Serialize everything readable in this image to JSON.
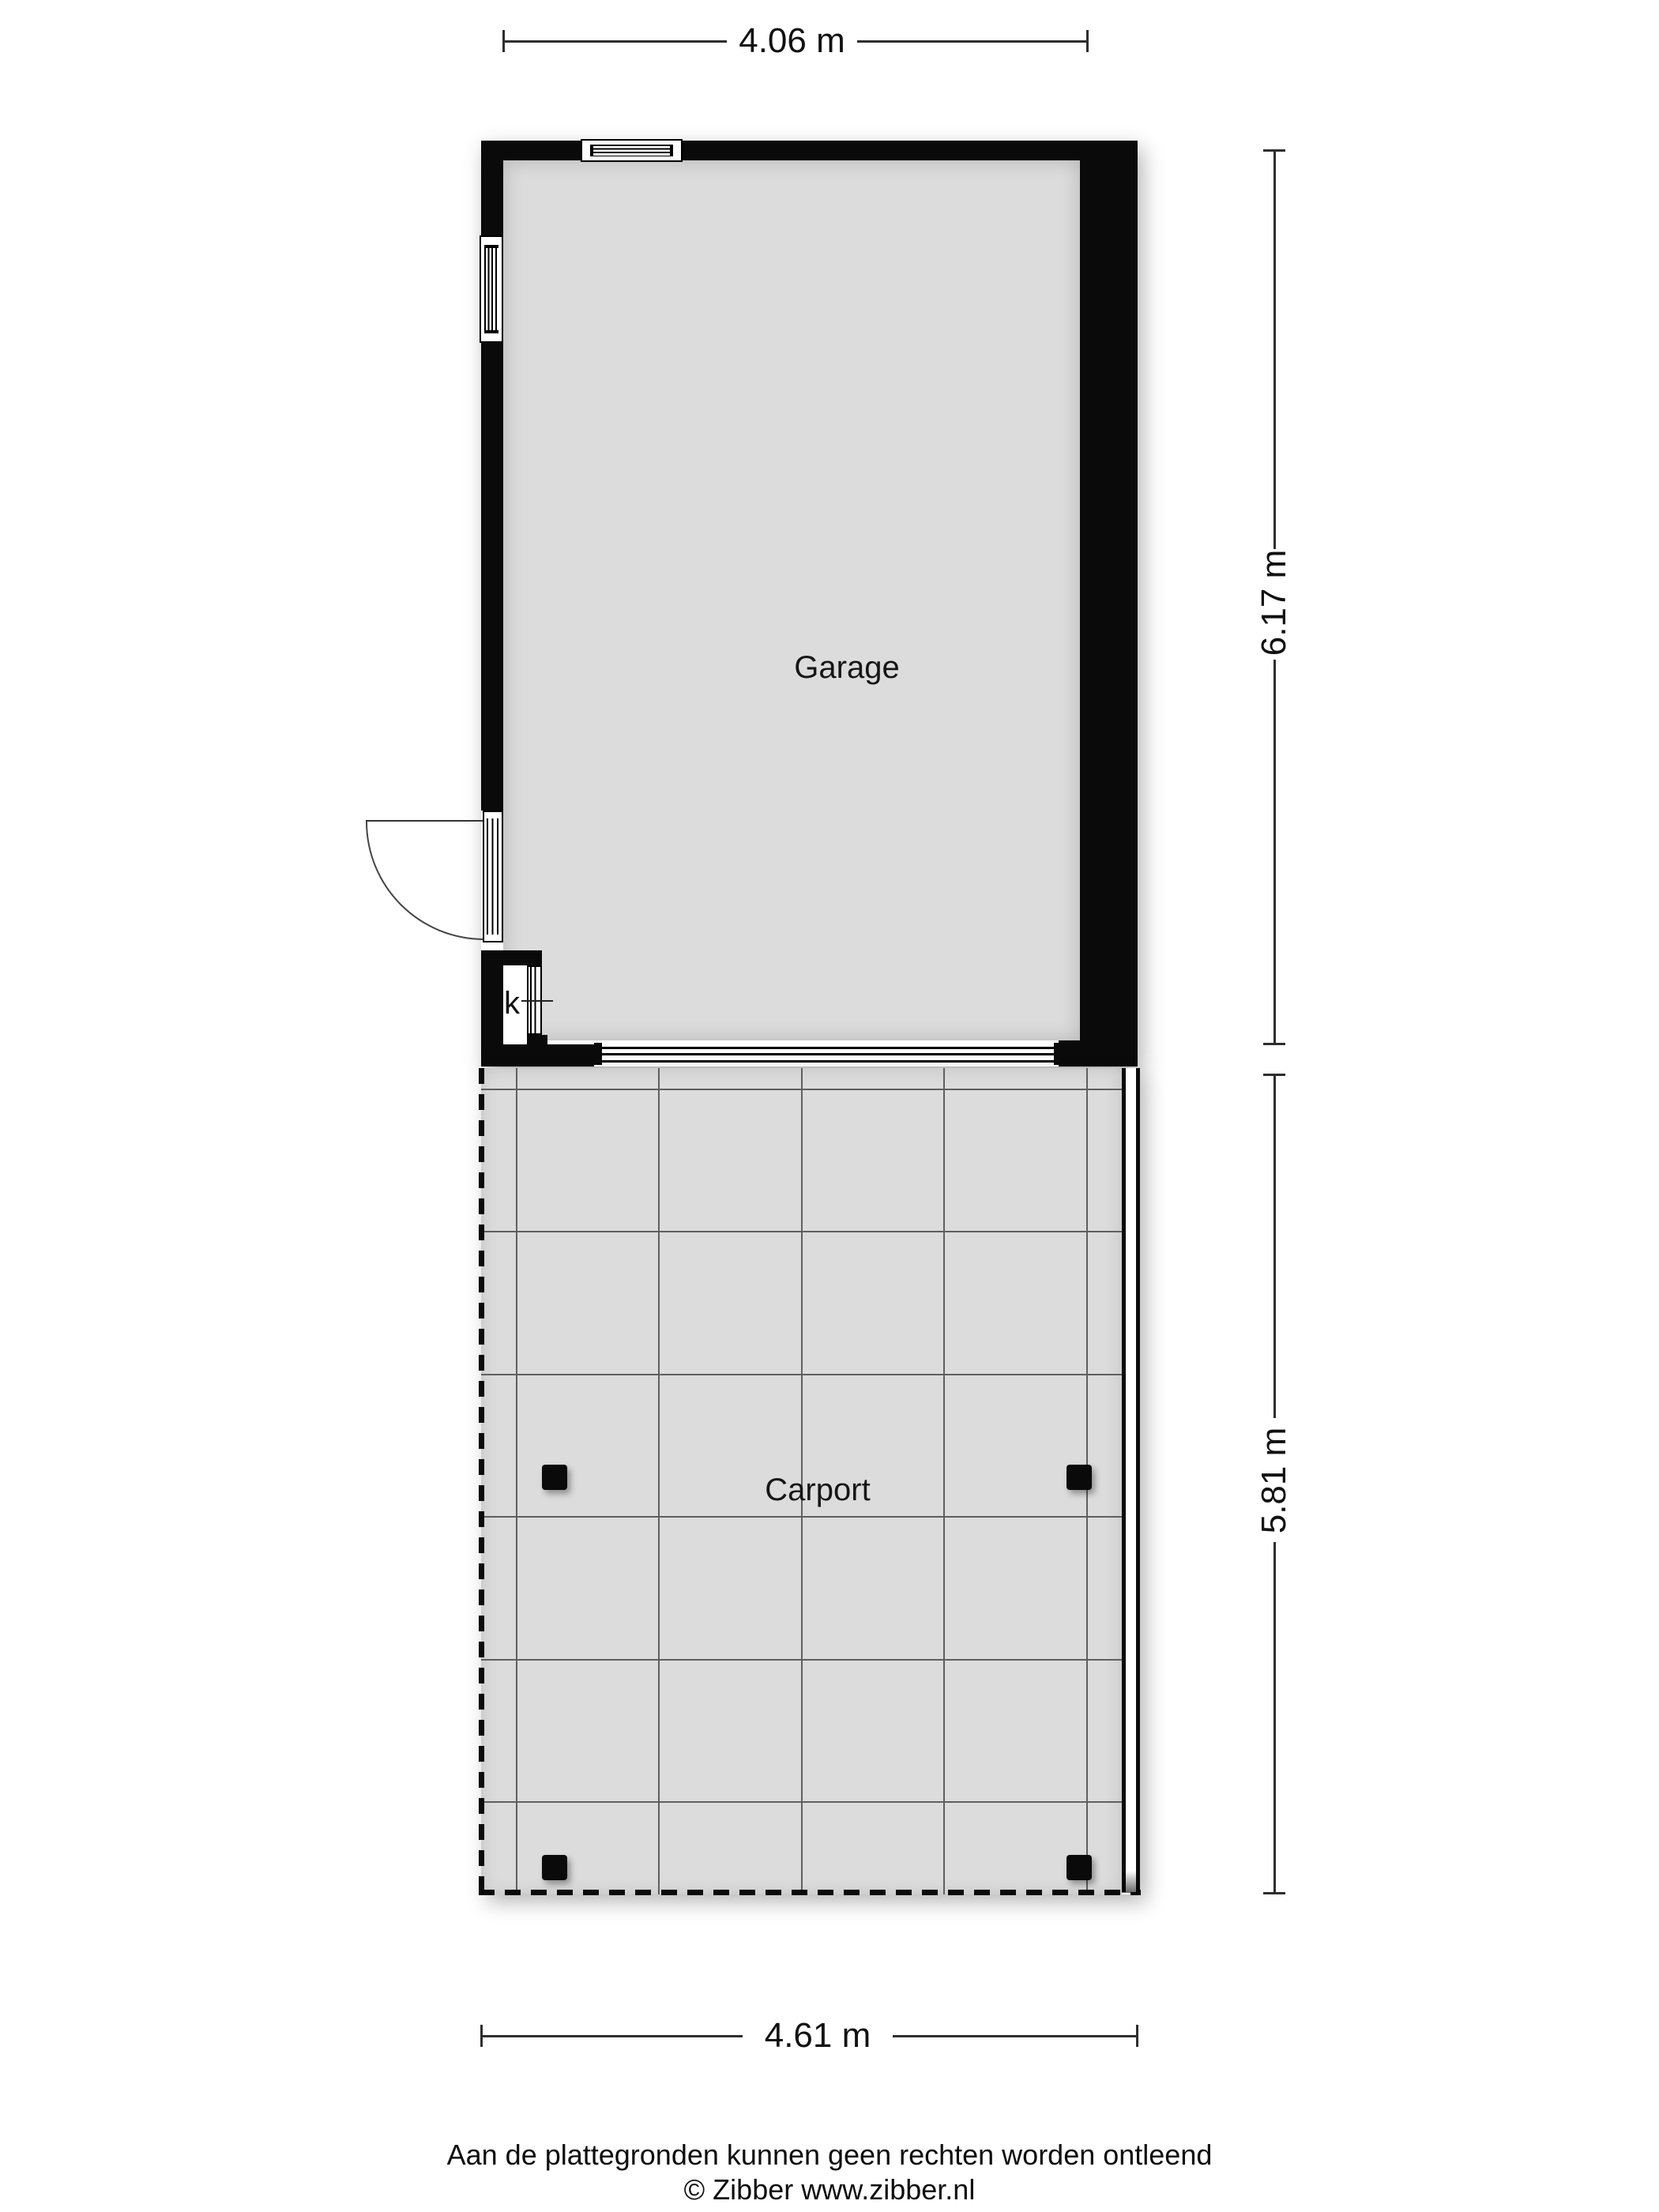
{
  "rooms": {
    "garage": {
      "label": "Garage"
    },
    "carport": {
      "label": "Carport"
    },
    "closet": {
      "label": "k"
    }
  },
  "dimensions": {
    "garage_width": {
      "label": "4.06 m"
    },
    "garage_height": {
      "label": "6.17 m"
    },
    "carport_height": {
      "label": "5.81 m"
    },
    "carport_width": {
      "label": "4.61 m"
    }
  },
  "footer": {
    "disclaimer": "Aan de plattegronden kunnen geen rechten worden ontleend",
    "copyright": "© Zibber www.zibber.nl"
  },
  "colors": {
    "background": "#ffffff",
    "floor": "#dcdcdc",
    "wall": "#0a0a0a",
    "grid": "#5f5f5f",
    "dimension": "#2e2e2e",
    "text": "#111111"
  }
}
